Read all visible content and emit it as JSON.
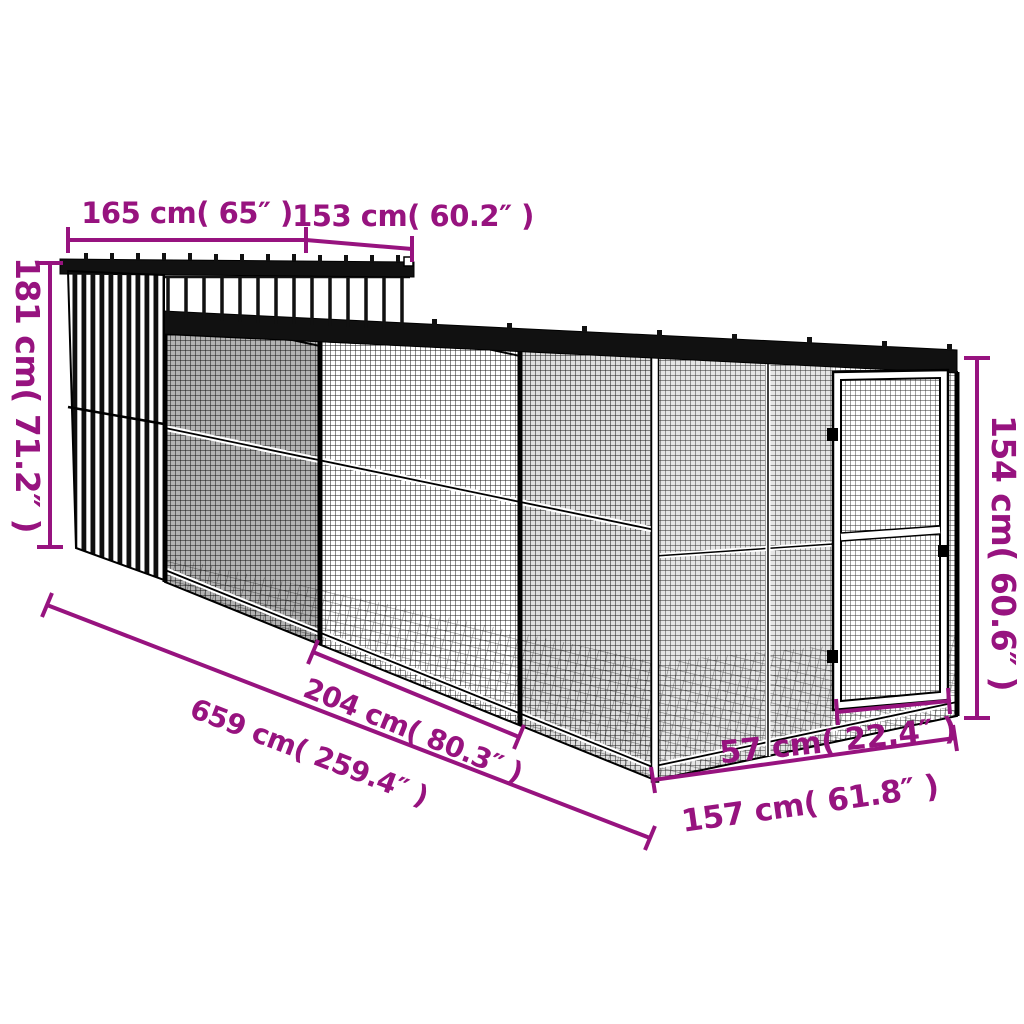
{
  "diagram": {
    "subject": "chicken-coop-with-run-dimension-diagram",
    "accent_color": "#97137F",
    "line_color": "#000000",
    "background_color": "#ffffff"
  },
  "dims": {
    "d165": {
      "cm": "165",
      "inch": "65",
      "label": "165 cm( 65″ )"
    },
    "d153": {
      "cm": "153",
      "inch": "60.2",
      "label": "153 cm( 60.2″ )"
    },
    "d181": {
      "cm": "181",
      "inch": "71.2",
      "label": "181 cm( 71.2″ )"
    },
    "d154": {
      "cm": "154",
      "inch": "60.6",
      "label": "154 cm( 60.6″ )"
    },
    "d659": {
      "cm": "659",
      "inch": "259.4",
      "label": "659 cm( 259.4″ )"
    },
    "d204": {
      "cm": "204",
      "inch": "80.3",
      "label": "204 cm( 80.3″ )"
    },
    "d57": {
      "cm": "57",
      "inch": "22.4",
      "label": "57 cm( 22.4″ )"
    },
    "d157": {
      "cm": "157",
      "inch": "61.8",
      "label": "157 cm( 61.8″ )"
    }
  }
}
